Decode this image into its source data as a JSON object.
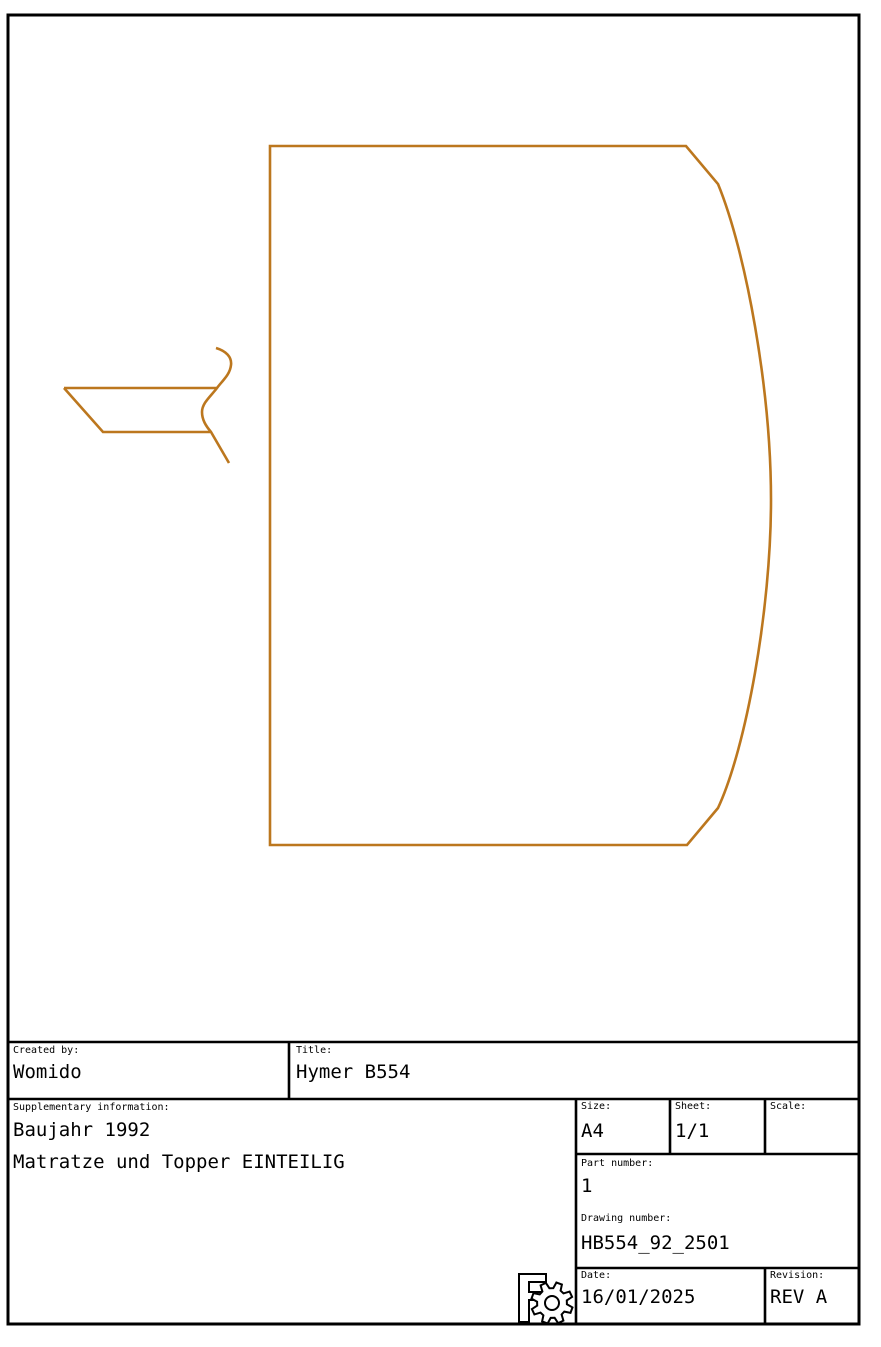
{
  "sheet": {
    "colors": {
      "background": "#ffffff",
      "frame_color": "#000000",
      "text_color": "#000000",
      "line_color": "#bc771e"
    }
  },
  "drawing": {
    "description": "Top-view outline of one-piece mattress with curved right edge, plus small cab/seat detail at left",
    "paths": {
      "mattress_outline": "M 270 146 L 686 146 L 718 184 C 746 252 771 390 771 500 C 771 610 746 748 718 808 L 687 845 L 270 845 Z",
      "detail_top_edge": "M 64 388 L 217 388",
      "detail_left_bottom_edge": "M 64 388 L 103 432 L 210 432",
      "detail_s_curve": "M 216 348 C 226 351 232 357 231 365 C 230 375 222 381 217 388 C 211 396 202 403 202 412 C 202 420 206 426 211 432 L 229 463"
    }
  },
  "title_block": {
    "created_by": {
      "label": "Created by:",
      "value": "Womido"
    },
    "title": {
      "label": "Title:",
      "value": "Hymer B554"
    },
    "supplementary": {
      "label": "Supplementary information:",
      "line1": "Baujahr 1992",
      "line2": "Matratze und Topper EINTEILIG"
    },
    "size": {
      "label": "Size:",
      "value": "A4"
    },
    "sheet_field": {
      "label": "Sheet:",
      "value": "1/1"
    },
    "scale": {
      "label": "Scale:",
      "value": ""
    },
    "part_number": {
      "label": "Part number:",
      "value": "1"
    },
    "drawing_number": {
      "label": "Drawing number:",
      "value": "HB554_92_2501"
    },
    "date": {
      "label": "Date:",
      "value": "16/01/2025"
    },
    "revision": {
      "label": "Revision:",
      "value": "REV A"
    }
  }
}
